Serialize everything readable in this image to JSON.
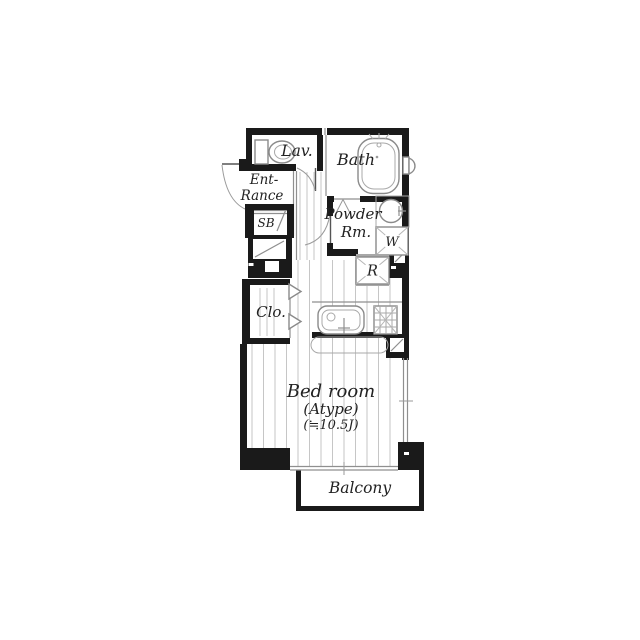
{
  "floorplan": {
    "lavatory_label": "Lav.",
    "bath_label": "Bath",
    "entrance_label_line1": "Ent-",
    "entrance_label_line2": "Rance",
    "shoebox_label": "SB",
    "powder_label_line1": "Powder",
    "powder_label_line2": "Rm.",
    "washer_label": "W",
    "refrigerator_label": "R",
    "closet_label": "Clo.",
    "bedroom_label_line1": "Bed room",
    "bedroom_label_line2": "(Atype)",
    "bedroom_label_line3": "(≒10.5J)",
    "balcony_label": "Balcony"
  },
  "colors": {
    "wall": "#1a1a1a",
    "fixture_stroke": "#8a8a8a",
    "floor_line": "#c6c6c6",
    "text": "#222222",
    "background": "#ffffff"
  }
}
